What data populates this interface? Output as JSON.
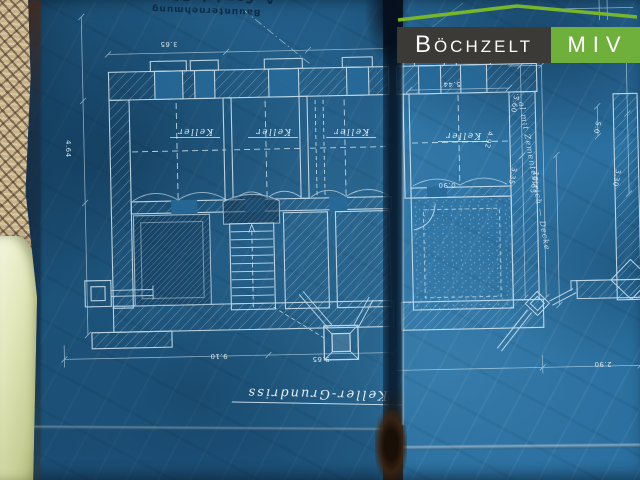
{
  "photo": {
    "subject": "Historic blueprint cellar floor plan photographed on a woven rug",
    "colors": {
      "blueprint": "#2a6f9f",
      "blueprint_dark": "#16496f",
      "linework": "#d6e9f4",
      "carpet": "#c9b288",
      "carpet_weave": "#3a2e22",
      "cloth": "#dde3b4",
      "tear": "#0b1d30",
      "tear_bottom": "#3a2413"
    }
  },
  "watermark": {
    "company": "Böchzelt",
    "unit": "MIV",
    "company_bg": "#3b3a36",
    "unit_bg": "#6faf3b",
    "roof_color": "#77b52c",
    "roof_icon": "roof-outline"
  },
  "stamp": {
    "line1": "Bauunternehmung",
    "line2": "A. Sandel, Bützau",
    "orientation": "rotated 180°"
  },
  "plan": {
    "title": "Keller-Grundriss",
    "orientation": "rotated 180°",
    "room_labels": [
      "Keller",
      "Keller",
      "Keller",
      "Keller"
    ],
    "note": "…al mit Zementestrich — Decke",
    "dims": [
      "3.65",
      "5.44",
      "9.10",
      "9.65",
      "2.90",
      "0.90",
      "4.64",
      "3.60",
      "3.35",
      "10.65",
      "5.0",
      "3.30",
      "4.92"
    ]
  }
}
